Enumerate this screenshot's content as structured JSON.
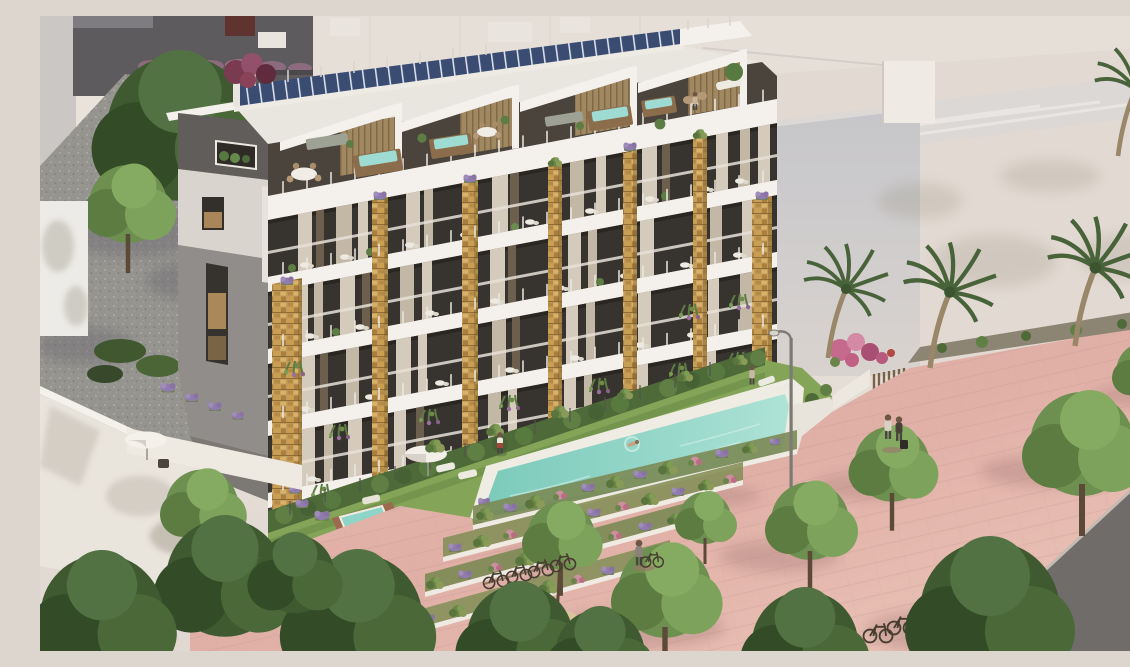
{
  "meta": {
    "domain": "Natural-Image",
    "alt": "Aerial photorealistic rendering of a modern six-level apartment building with a rooftop solar panel array, penthouse terraces with hot tubs and dining sets, white balcony slabs on golden stone-clad piers, cascading balcony plants, ground-floor gardens with parasols and plunge pools, a long turquoise lap pool with a swimmer, terraced flower beds, and a pink paved promenade lined with leafy trees, palm trees, street lamps, parked bicycles and pedestrians, flanked by beige neighbouring buildings and a grey road."
  },
  "scene": {
    "style": "photorealistic CGI architectural visualization",
    "camera": "elevated three-quarter aerial view from the south-west",
    "lighting": "warm late-afternoon sunlight from the right",
    "main_building": {
      "levels_visible": 6,
      "features": [
        "tilted rooftop solar panel array",
        "sawtooth white penthouse rooflines",
        "penthouse terraces with wooden hot tubs, round dining tables and loungers",
        "white balcony slabs with glass balustrades",
        "golden stone-mosaic piers between balcony bays",
        "floor-to-ceiling glazing with beige curtains",
        "hanging green and purple balcony plants",
        "grey gable end with slot windows and timber shutters",
        "ground-floor private gardens with parasol, loungers and plunge pool",
        "green privacy hedge with glass fence"
      ]
    },
    "amenities": {
      "pool": "elongated turquoise lap pool with white deck and one swimmer",
      "lawn": "grass strip with sun loungers beside the pool",
      "planting": "stepped flower terraces with lavender, olive and pink planting",
      "promenade": "pink paved boulevard with leafy trees, tree-ring planter, bicycle rack and street lamps"
    },
    "surroundings": [
      "dark grey building with maroon box and mauve roof planting at top left",
      "light grey wall and gravel yard with mature green trees on the left",
      "white rooftop terrace with parasol and chair at lower left",
      "large beige and cream buildings with palm shadows on the right",
      "four palm trees along the promenade",
      "dark asphalt road at lower right"
    ],
    "counts": {
      "people": 7,
      "bicycles": 6,
      "palm_trees": 4,
      "hot_tubs": 4,
      "street_lamps": 2
    },
    "palette": {
      "solar_panel_blue": "#3a4c72",
      "facade_white": "#f4f1ec",
      "stone_gold": "#c49d5a",
      "window_dark": "#37332e",
      "curtain_beige": "#d5cbbc",
      "hedge_green": "#4e6a38",
      "lawn_green": "#84a558",
      "pool_turquoise": "#8fd4c6",
      "paving_pink": "#e2b2a9",
      "tree_green": "#3f5a31",
      "road_grey": "#6f6c6a",
      "backdrop_cream": "#e7dfd8",
      "gravel_grey": "#96948f",
      "flower_purple": "#8f7bac",
      "flower_pink": "#cc8f9e",
      "timber_tan": "#a08861"
    }
  }
}
